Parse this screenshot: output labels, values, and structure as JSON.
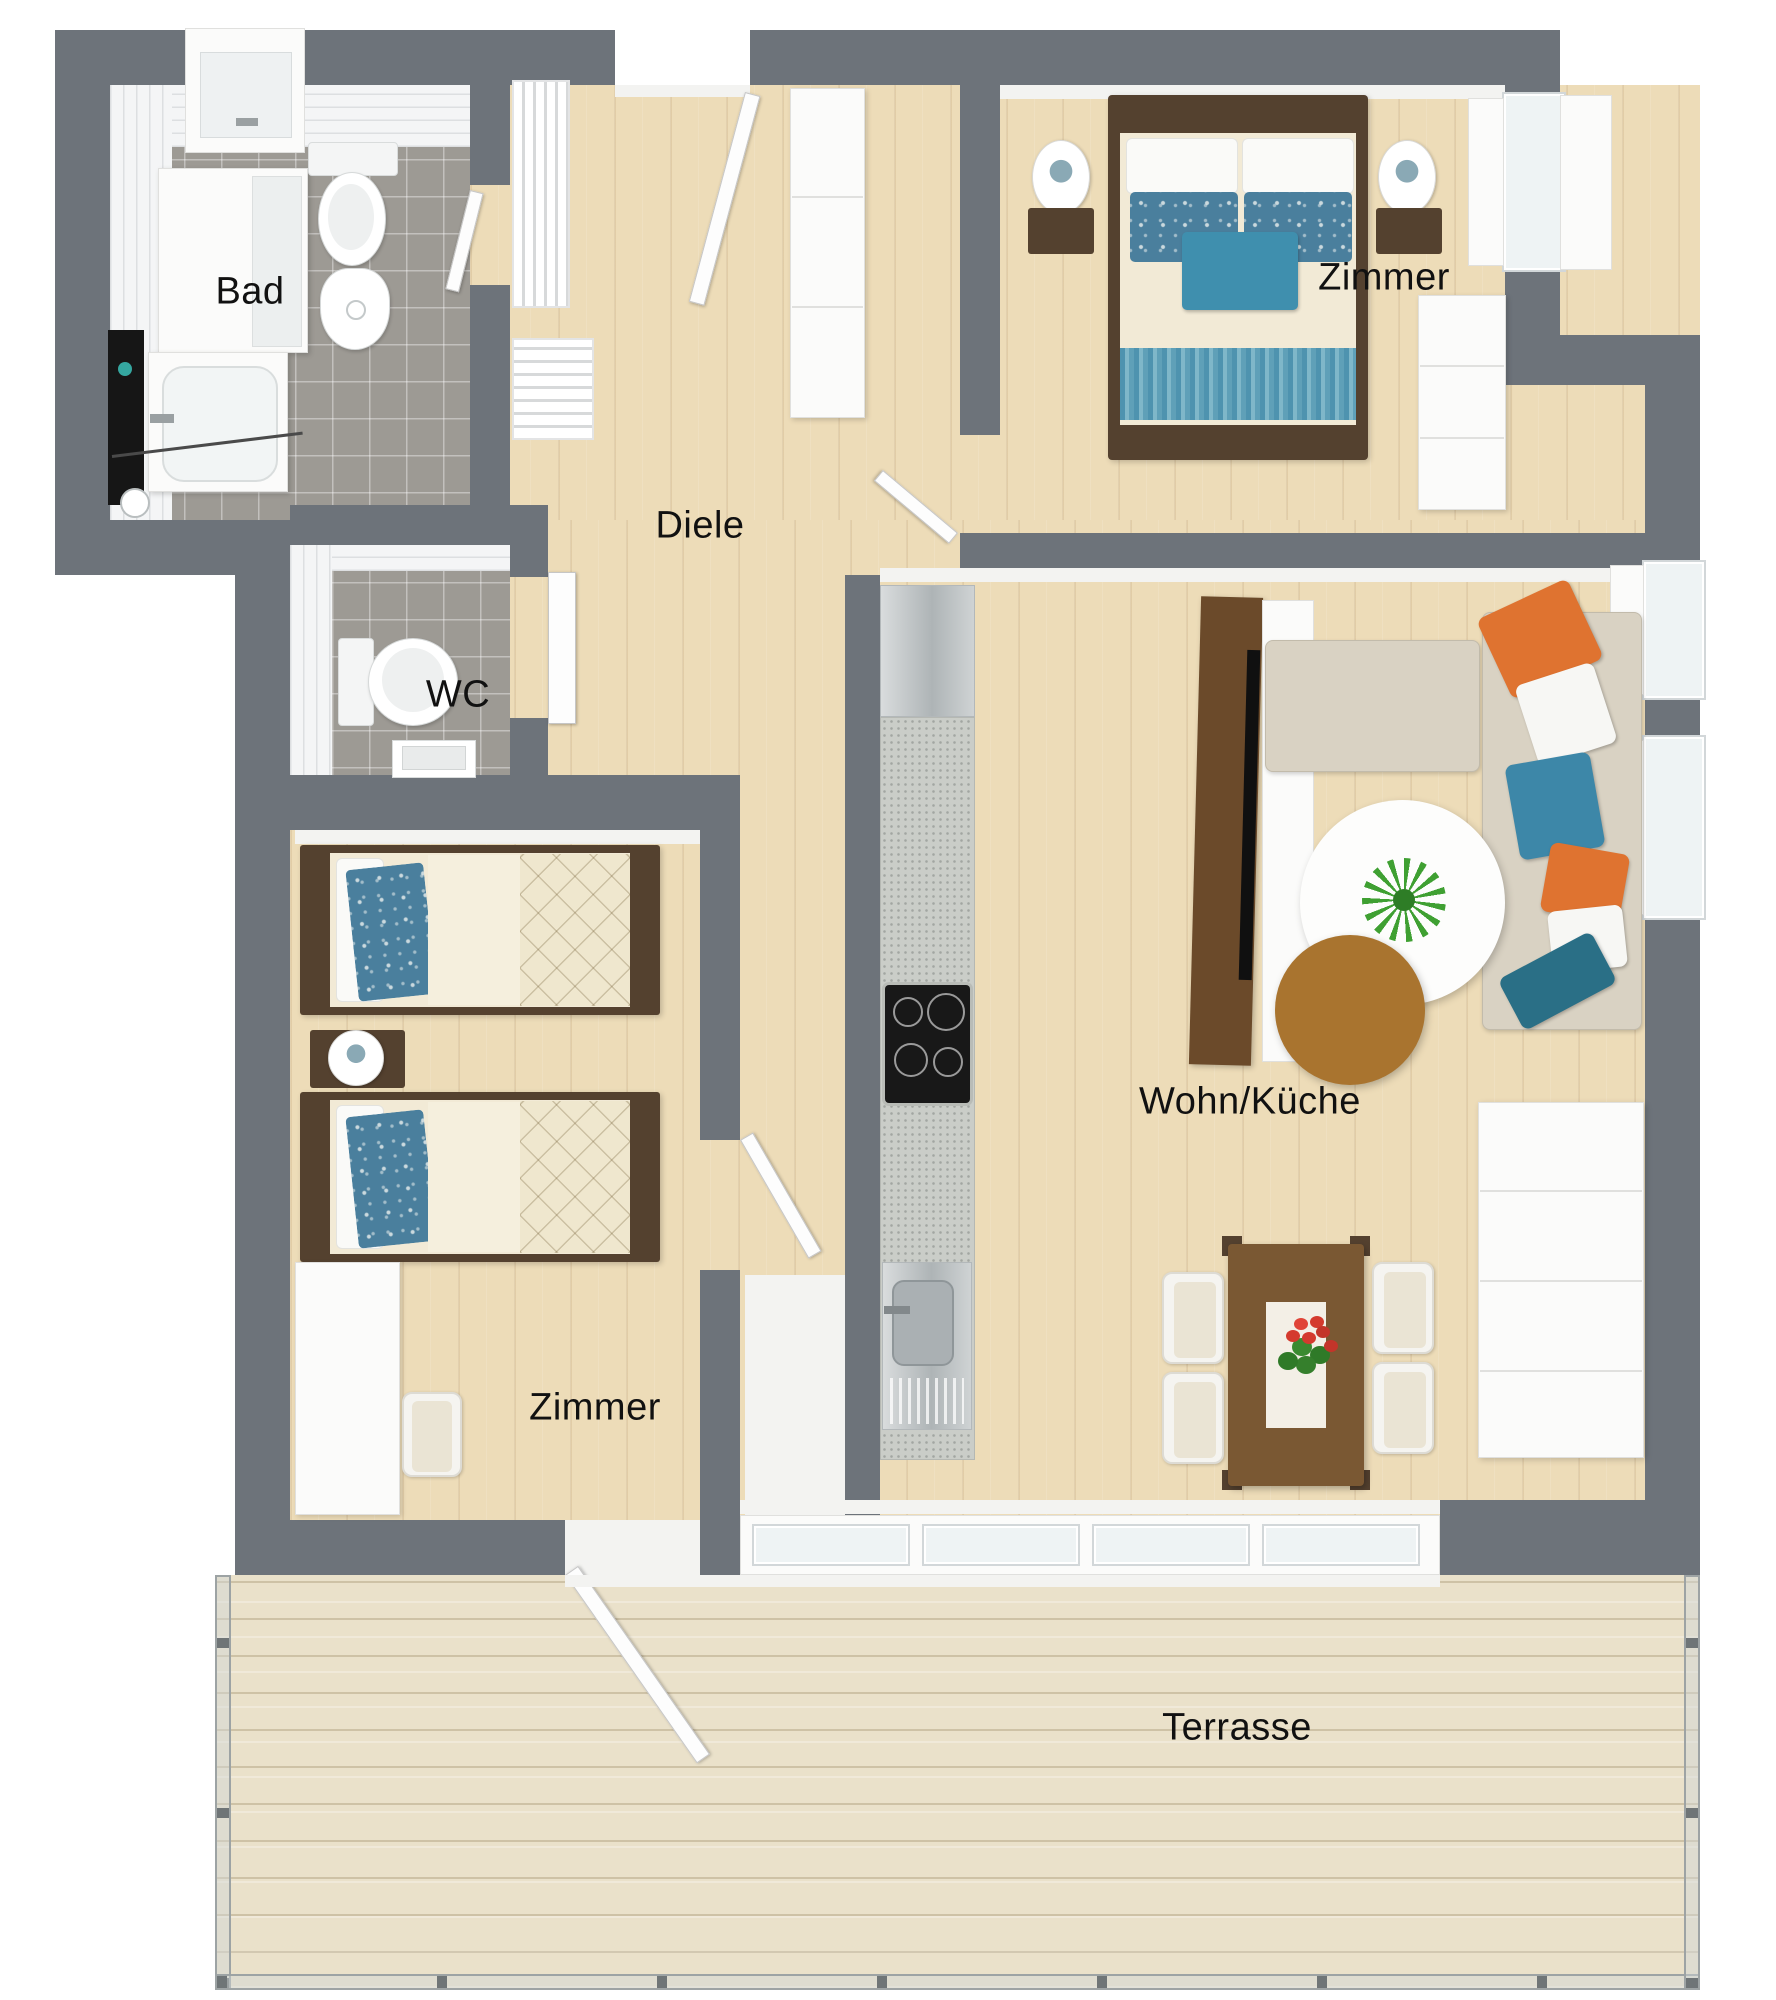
{
  "plan_type": "apartment-floor-plan-3d-top-view",
  "rooms": [
    {
      "id": "bad",
      "label": "Bad"
    },
    {
      "id": "wc",
      "label": "WC"
    },
    {
      "id": "diele",
      "label": "Diele"
    },
    {
      "id": "zimmer_nord",
      "label": "Zimmer"
    },
    {
      "id": "wohn_kueche",
      "label": "Wohn/Küche"
    },
    {
      "id": "zimmer_sued",
      "label": "Zimmer"
    },
    {
      "id": "terrasse",
      "label": "Terrasse"
    }
  ],
  "palette": {
    "wall": "#6d737a",
    "wood": "#eddcb8",
    "terrace": "#eae1ca",
    "tile": "#9d9a94",
    "darkwood": "#54412f",
    "teal": "#3f8fae",
    "orange": "#df7330",
    "sofa": "#d9d2c3",
    "label": "#111111"
  },
  "furniture": {
    "bad": [
      "shower-niche",
      "washing-machine",
      "mirror",
      "vanity-sink",
      "toilet",
      "bidet",
      "walk-in-shower-glass"
    ],
    "wc": [
      "toilet",
      "hand-sink"
    ],
    "diele": [
      "coat-cabinet",
      "slatted-radiator",
      "slatted-bench",
      "entrance-door"
    ],
    "zimmer_nord": [
      "double-bed",
      "nightstand-left",
      "nightstand-right",
      "table-lamps",
      "wardrobe",
      "dresser"
    ],
    "wohn_kueche": [
      "fridge",
      "kitchen-counter",
      "cooktop",
      "kitchen-sink",
      "tv-panel",
      "corner-sofa",
      "coffee-table-white",
      "coffee-table-wood",
      "plant",
      "dining-table",
      "dining-chairs",
      "sideboard"
    ],
    "zimmer_sued": [
      "single-bed-1",
      "single-bed-2",
      "nightstand",
      "table-lamp",
      "desk",
      "desk-chair"
    ],
    "terrasse": [
      "glass-railing",
      "wood-decking"
    ]
  }
}
